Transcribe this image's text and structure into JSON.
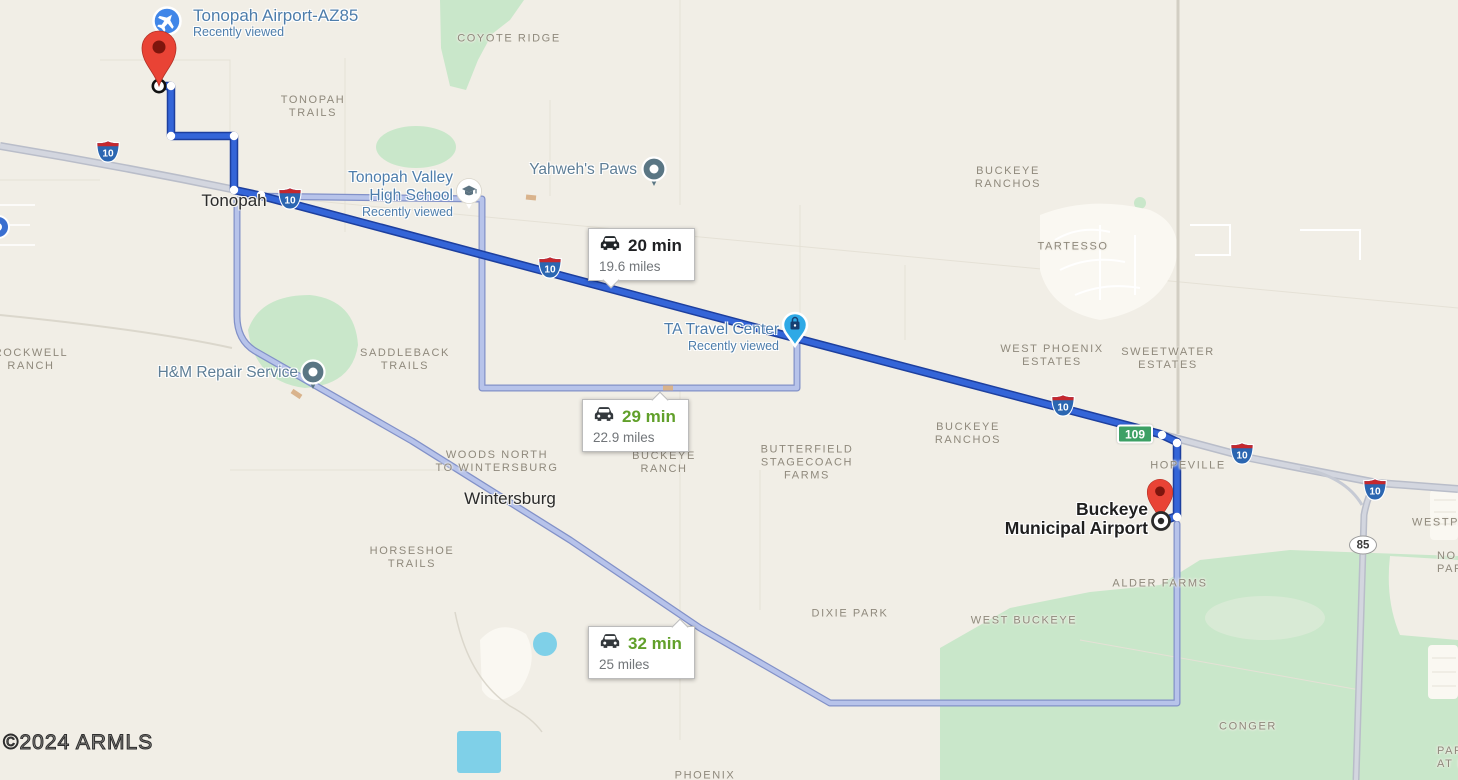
{
  "attribution": "©2024 ARMLS",
  "start_poi": {
    "title": "Tonopah Airport-AZ85",
    "subtitle": "Recently viewed"
  },
  "destination_poi": {
    "line1": "Buckeye",
    "line2": "Municipal Airport"
  },
  "route_options": [
    {
      "duration": "20 min",
      "distance": "19.6 miles",
      "selected": true
    },
    {
      "duration": "29 min",
      "distance": "22.9 miles",
      "selected": false
    },
    {
      "duration": "32 min",
      "distance": "25 miles",
      "selected": false
    }
  ],
  "pois": {
    "yahwehs_paws": {
      "label": "Yahweh's Paws"
    },
    "tonopah_valley_hs": {
      "line1": "Tonopah Valley",
      "line2": "High School",
      "subtitle": "Recently viewed"
    },
    "ta_travel_center": {
      "label": "TA Travel Center",
      "subtitle": "Recently viewed"
    },
    "hm_repair": {
      "label": "H&M Repair Service"
    }
  },
  "towns": {
    "tonopah": "Tonopah",
    "wintersburg": "Wintersburg"
  },
  "area_labels": {
    "coyote_ridge": {
      "lines": [
        "COYOTE RIDGE"
      ]
    },
    "tonopah_trails": {
      "lines": [
        "TONOPAH",
        "TRAILS"
      ]
    },
    "buckeye_ranchos_north": {
      "lines": [
        "BUCKEYE",
        "RANCHOS"
      ]
    },
    "tartesso": {
      "lines": [
        "TARTESSO"
      ]
    },
    "rockwell_ranch": {
      "lines": [
        "ROCKWELL",
        "RANCH"
      ]
    },
    "saddleback_trails": {
      "lines": [
        "SADDLEBACK",
        "TRAILS"
      ]
    },
    "west_phoenix_estates": {
      "lines": [
        "WEST PHOENIX",
        "ESTATES"
      ]
    },
    "sweetwater_estates": {
      "lines": [
        "SWEETWATER",
        "ESTATES"
      ]
    },
    "buckeye_ranchos_south": {
      "lines": [
        "BUCKEYE",
        "RANCHOS"
      ]
    },
    "woods_north": {
      "lines": [
        "WOODS NORTH",
        "TO WINTERSBURG"
      ]
    },
    "buckeye_ranch": {
      "lines": [
        "BUCKEYE",
        "RANCH"
      ]
    },
    "butterfield": {
      "lines": [
        "BUTTERFIELD",
        "STAGECOACH",
        "FARMS"
      ]
    },
    "hopeville": {
      "lines": [
        "HOPEVILLE"
      ]
    },
    "horseshoe_trails": {
      "lines": [
        "HORSESHOE",
        "TRAILS"
      ]
    },
    "alder_farms": {
      "lines": [
        "ALDER FARMS"
      ]
    },
    "dixie_park": {
      "lines": [
        "DIXIE PARK"
      ]
    },
    "west_buckeye": {
      "lines": [
        "WEST BUCKEYE"
      ]
    },
    "conger": {
      "lines": [
        "CONGER"
      ]
    },
    "phoenix": {
      "lines": [
        "PHOENIX"
      ]
    },
    "westpark_edge": {
      "lines": [
        "WESTPA"
      ]
    },
    "north_park_edge": {
      "lines": [
        "NO",
        "PAR"
      ]
    },
    "park_at_edge": {
      "lines": [
        "PAR",
        "AT B"
      ]
    }
  },
  "shields": {
    "interstate_10": "10",
    "state_109": "109",
    "state_85": "85"
  },
  "icons": {
    "start_poi": "airplane-icon",
    "school": "graduation-cap-icon",
    "ta_travel_center": "shopping-bag-pin-icon",
    "generic_poi": "dot-pin-icon",
    "route_label": "car-icon",
    "start_marker": "red-pin-icon",
    "destination_marker": "red-pin-icon",
    "destination_point": "target-circle-icon"
  },
  "colors": {
    "route_primary": "#3465d8",
    "route_primary_casing": "#1d3f9e",
    "route_alternate": "#b7c3ea",
    "route_alternate_casing": "#8291c8",
    "map_background": "#f1eee6",
    "park_green": "#c9e7ca",
    "water": "#7fd0e8",
    "duration_selected": "#202124",
    "duration_alternate": "#61a02a",
    "interstate_shield_blue": "#2b66b1",
    "interstate_shield_red": "#c5282e",
    "state_shield_green": "#3da065"
  }
}
